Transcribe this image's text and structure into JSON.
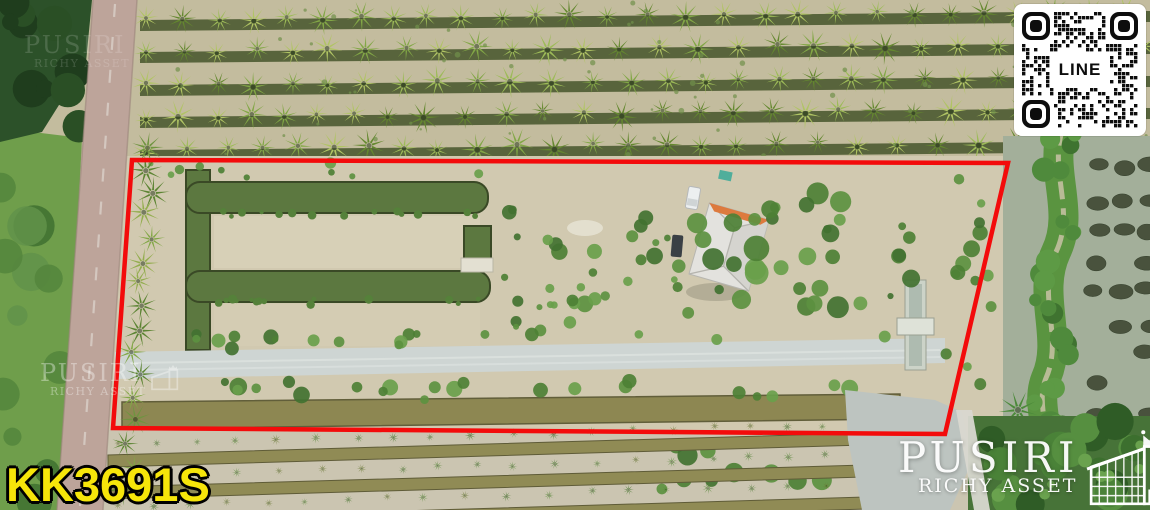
{
  "image": {
    "kind": "real-estate aerial drone photo",
    "subject": "land plot outlined in red among coconut plantation, ponds and canals"
  },
  "listing": {
    "code": "KK3691S",
    "code_color": "#f6e50a"
  },
  "boundary": {
    "color": "#f30b0b",
    "stroke_width": 4.5,
    "points": [
      [
        132,
        160
      ],
      [
        1008,
        163
      ],
      [
        945,
        434
      ],
      [
        113,
        428
      ]
    ]
  },
  "qr": {
    "label": "LINE",
    "module_color": "#0d0d0d",
    "background": "#ffffff"
  },
  "branding": {
    "name": "PUSIRI",
    "subtitle": "RICHY ASSET",
    "logo_color": "#ffffff",
    "icons": [
      "crown-icon",
      "house-icon"
    ]
  },
  "palette": {
    "soil": "#cfc7ae",
    "plot_soil": "#d1c9b0",
    "plantation_soil": "#c3bc9e",
    "channel_dark": "#4c5a31",
    "pond_green": "#5c7840",
    "pond_edge": "#3a4926",
    "palm_greens": [
      "#82a746",
      "#9dbb58",
      "#64882f",
      "#b0c464"
    ],
    "bush_greens": [
      "#4d8035",
      "#5c9140",
      "#427231",
      "#69a04b"
    ],
    "grass_left": "#6f9e4b",
    "forest_dark": "#2c5129",
    "road": "#bda49a",
    "cross_road": "#ced5d3",
    "canal_khaki": "#8d8752",
    "water_right": "#a3af9a",
    "mound": "#49523d",
    "trees_dark": "#3c6f2e",
    "gray_water": "#bdc4c0",
    "wall": "#d9d8d0",
    "roof_white": "#e3e2de",
    "roof_ridge_orange": "#dd7a3e"
  }
}
